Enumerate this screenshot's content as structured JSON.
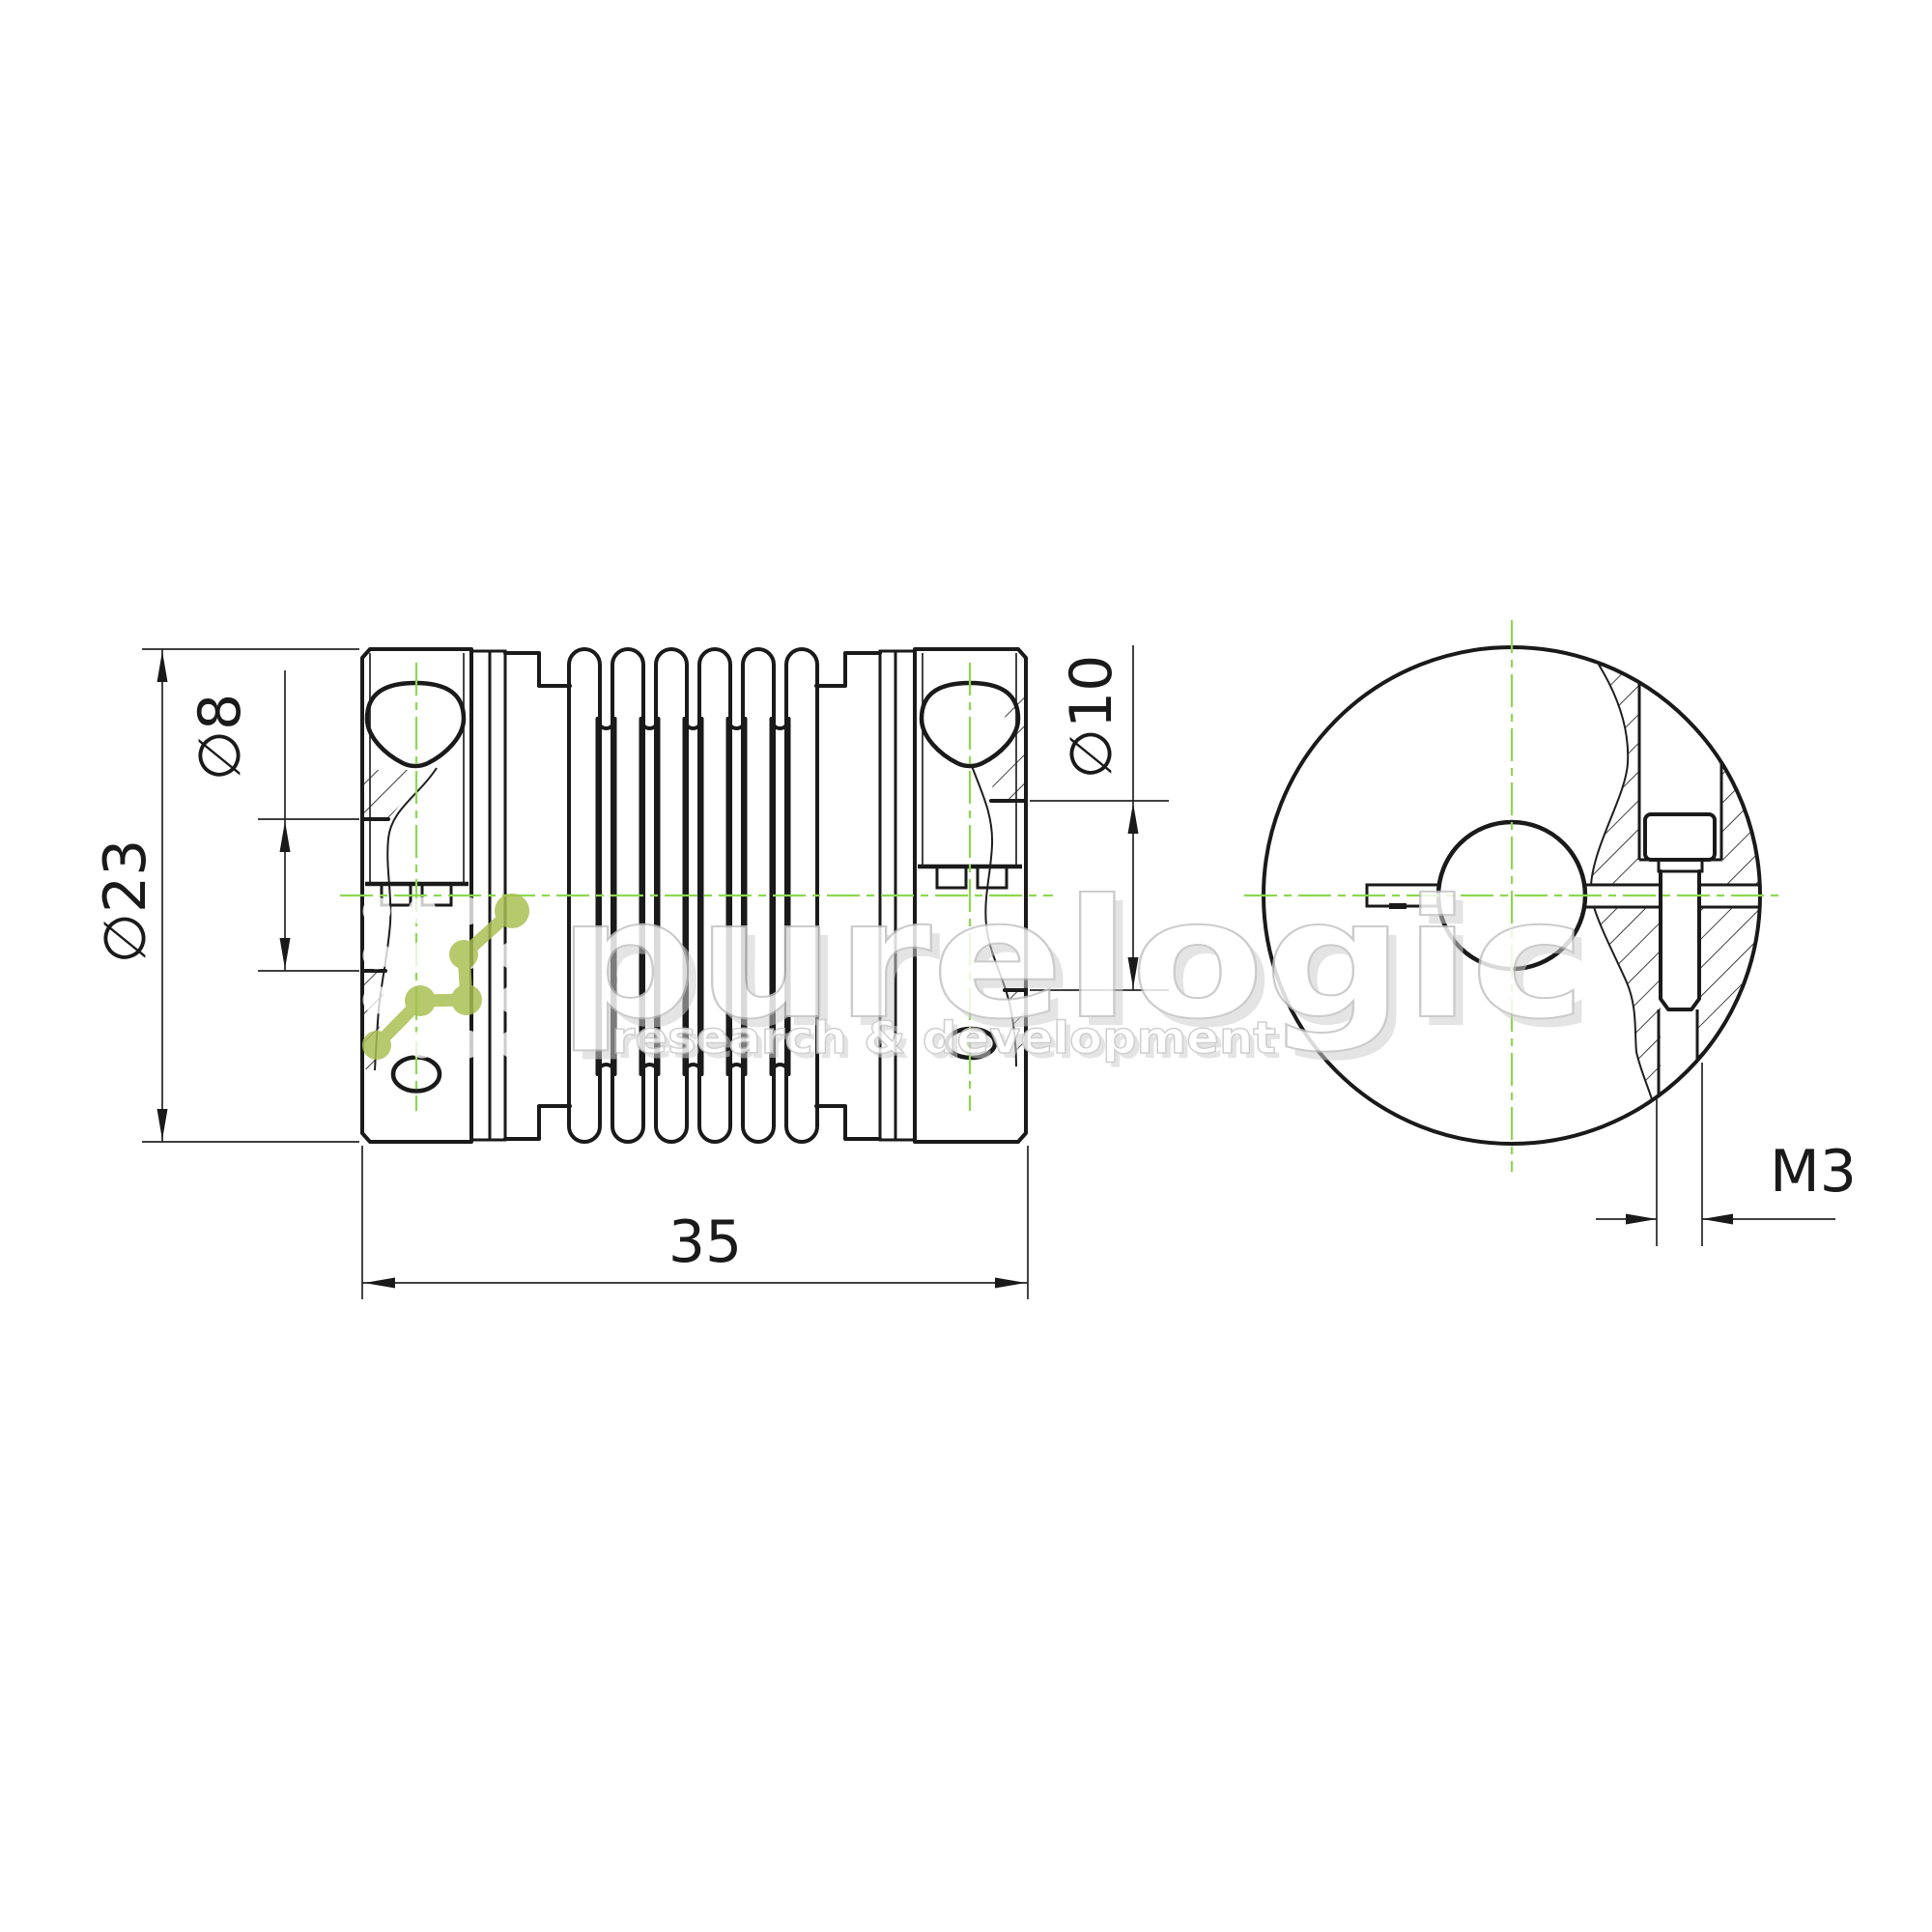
{
  "drawing": {
    "type": "technical-drawing",
    "subject": "bellows flexible shaft coupling, section view and side view",
    "dimension_labels": {
      "outer_diameter": "∅23",
      "left_bore": "∅8",
      "right_bore": "∅10",
      "overall_length": "35",
      "clamp_screw_thread": "M3"
    },
    "colors": {
      "background": "#ffffff",
      "line": "#1a1a1a",
      "centerline": "#8cd84f"
    }
  },
  "watermark": {
    "brand": "purelogic",
    "tagline": "research & development",
    "logo_color": "#a9bf52",
    "text_color": "#ffffff",
    "shadow_color": "#cccccc"
  }
}
